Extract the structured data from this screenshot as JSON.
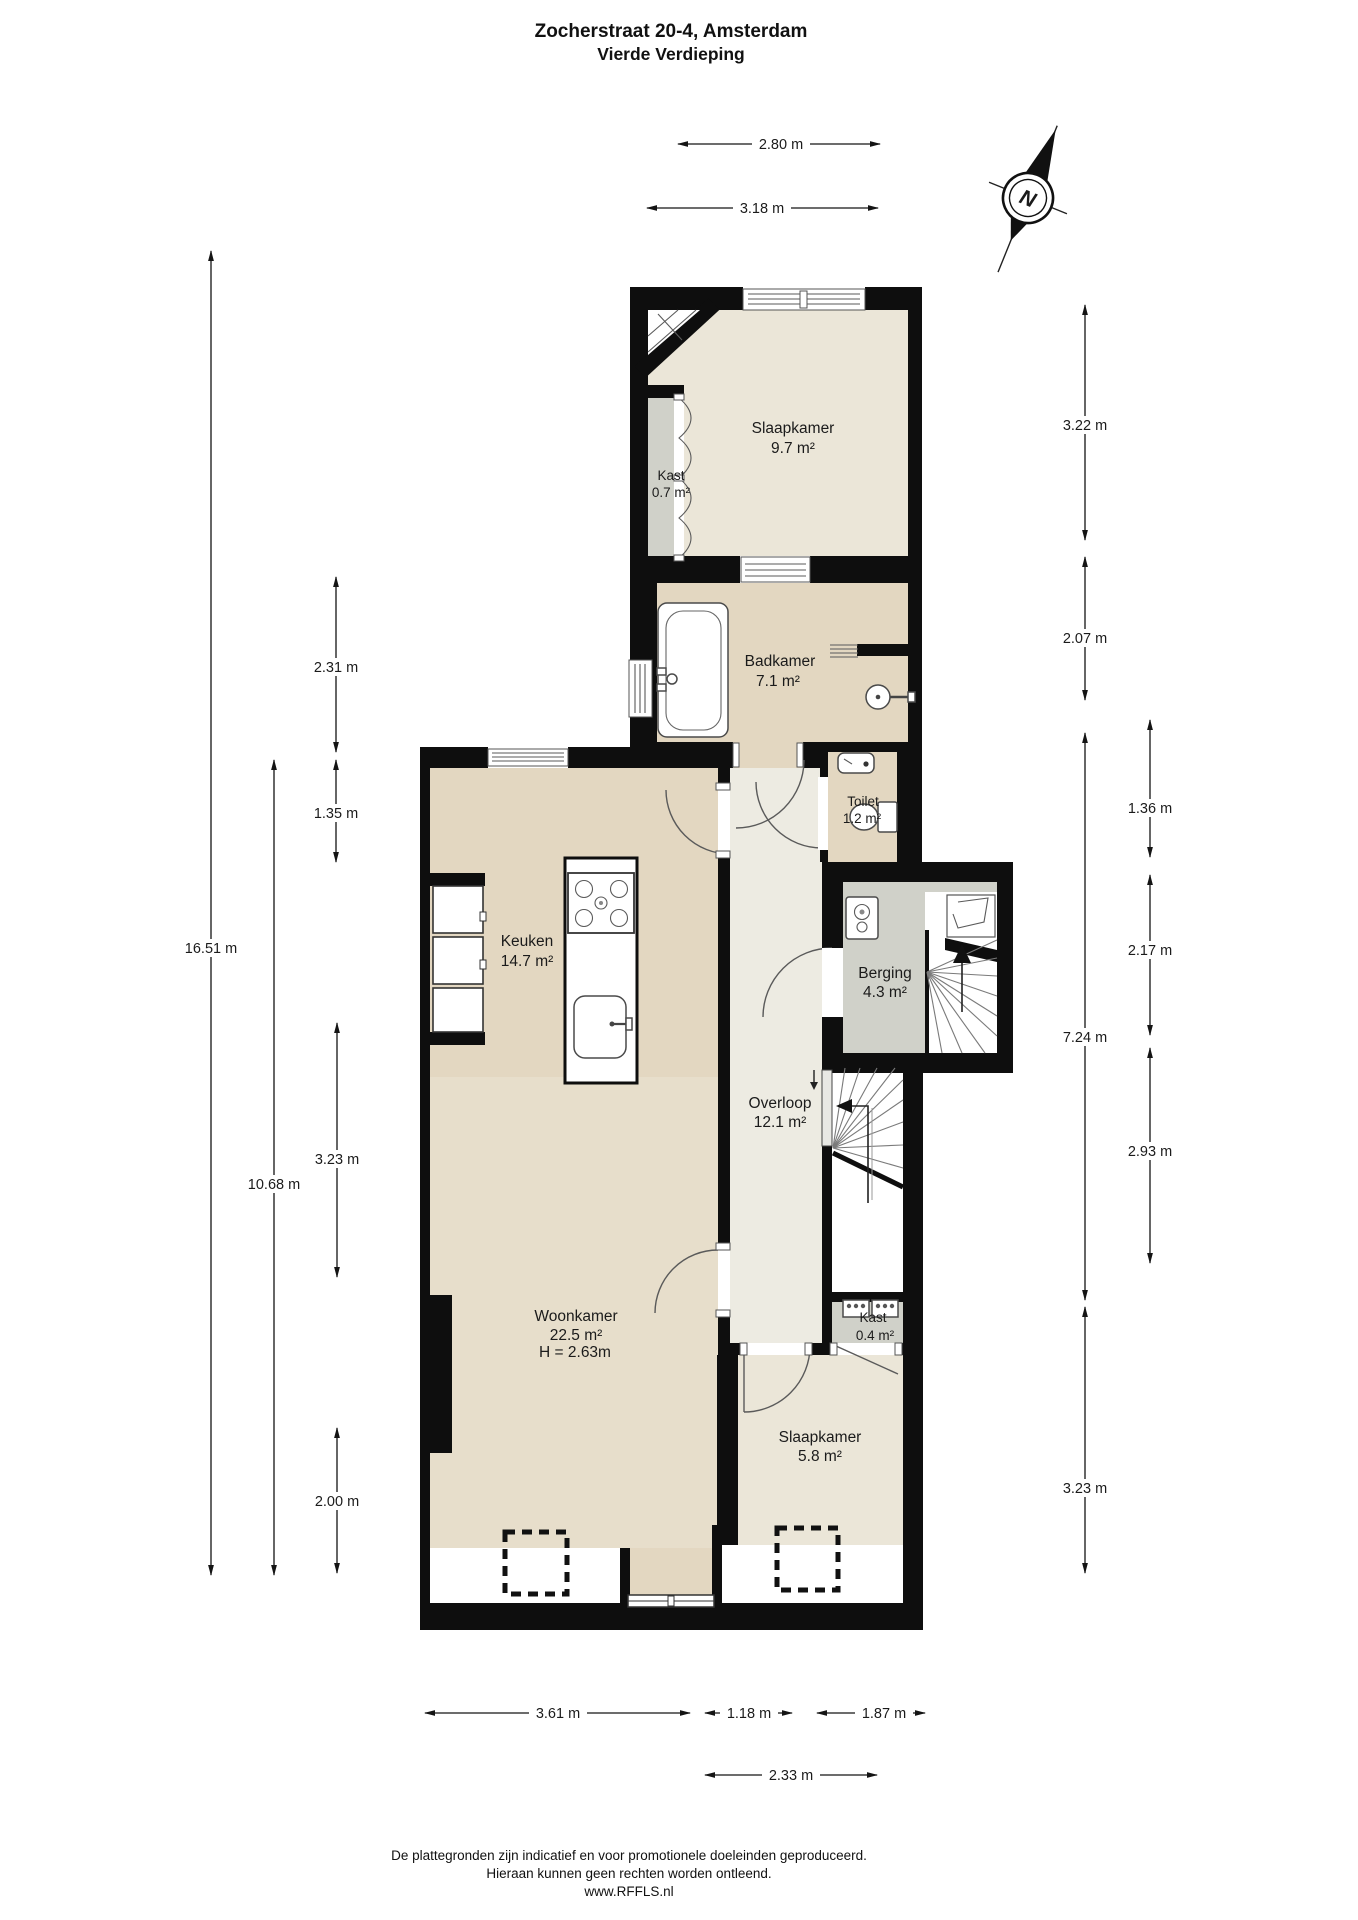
{
  "title": {
    "line1": "Zocherstraat 20-4, Amsterdam",
    "line2": "Vierde Verdieping"
  },
  "compass": {
    "label": "N"
  },
  "rooms": {
    "slaapkamer1": {
      "name": "Slaapkamer",
      "area": "9.7 m²"
    },
    "kast1": {
      "name": "Kast",
      "area": "0.7 m²"
    },
    "badkamer": {
      "name": "Badkamer",
      "area": "7.1 m²"
    },
    "toilet": {
      "name": "Toilet",
      "area": "1.2 m²"
    },
    "keuken": {
      "name": "Keuken",
      "area": "14.7 m²"
    },
    "berging": {
      "name": "Berging",
      "area": "4.3 m²"
    },
    "overloop": {
      "name": "Overloop",
      "area": "12.1 m²"
    },
    "woonkamer": {
      "name": "Woonkamer",
      "area": "22.5 m²",
      "ceiling_height": "H = 2.63m"
    },
    "kast2": {
      "name": "Kast",
      "area": "0.4 m²"
    },
    "slaapkamer2": {
      "name": "Slaapkamer",
      "area": "5.8 m²"
    }
  },
  "dimensions": {
    "top": [
      {
        "label": "2.80 m"
      },
      {
        "label": "3.18 m"
      }
    ],
    "left": [
      {
        "label": "16.51 m"
      },
      {
        "label": "10.68 m"
      },
      {
        "label": "2.31 m"
      },
      {
        "label": "1.35 m"
      },
      {
        "label": "3.23 m"
      },
      {
        "label": "2.00 m"
      }
    ],
    "right": [
      {
        "label": "3.22 m"
      },
      {
        "label": "2.07 m"
      },
      {
        "label": "7.24 m"
      },
      {
        "label": "3.23 m"
      },
      {
        "label": "1.36 m"
      },
      {
        "label": "2.17 m"
      },
      {
        "label": "2.93 m"
      }
    ],
    "bottom": [
      {
        "label": "3.61 m"
      },
      {
        "label": "1.18 m"
      },
      {
        "label": "1.87 m"
      },
      {
        "label": "2.33 m"
      }
    ]
  },
  "footer": {
    "line1": "De plattegronden zijn indicatief en voor promotionele doeleinden geproduceerd.",
    "line2": "Hieraan kunnen geen rechten worden ontleend.",
    "line3": "www.RFFLS.nl"
  },
  "colors": {
    "wall": "#0e0e0e",
    "bedroom": "#ebe6d8",
    "kitchen_bath": "#e3d7c1",
    "living": "#e7decb",
    "storage_gray": "#d0d1c9",
    "hall": "#edebe2",
    "background": "#ffffff"
  }
}
